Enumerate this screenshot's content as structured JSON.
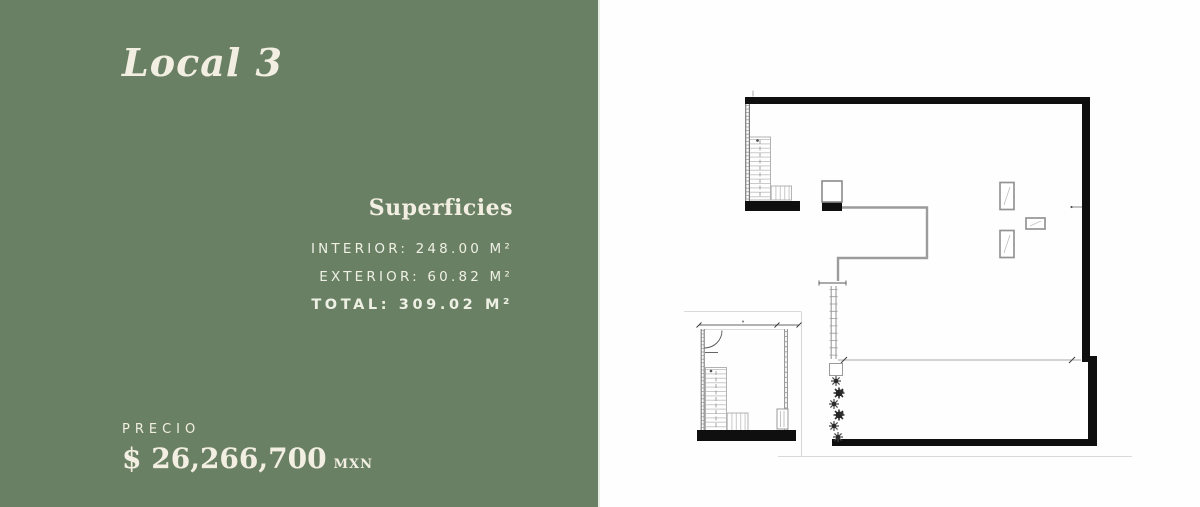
{
  "left_panel": {
    "title": "Local 3",
    "superficies": {
      "heading": "Superficies",
      "lines": [
        "INTERIOR: 248.00 M²",
        "EXTERIOR: 60.82 M²",
        "TOTAL: 309.02 M²"
      ]
    },
    "price": {
      "label": "PRECIO",
      "amount": "$ 26,266,700",
      "currency": "MXN"
    }
  },
  "floor_plan": {
    "content": "architectural floor plan of Local 3 with main level, staircases, terrace with planting, structural columns and a lower stair-lobby plan"
  },
  "colors": {
    "panel_background": "#6a8064",
    "text_cream": "#f2efe2",
    "plan_wall_black": "#0f0f0f",
    "plan_wall_gray": "#9c9c9c",
    "background_white": "#fefefe"
  }
}
